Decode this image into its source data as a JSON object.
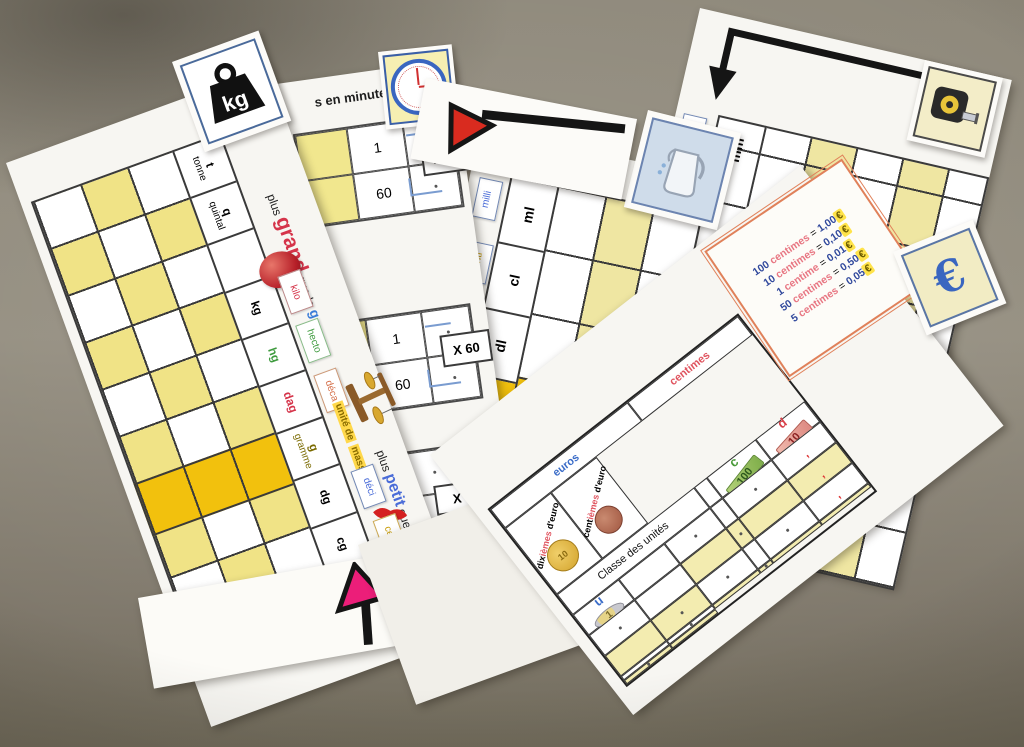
{
  "mass_paper": {
    "icon_label": "kg",
    "units": [
      {
        "abbr": "t",
        "name": "tonne"
      },
      {
        "abbr": "q",
        "name": "quintal"
      },
      {
        "abbr": "",
        "name": ""
      },
      {
        "abbr": "kg",
        "name": ""
      },
      {
        "abbr": "hg",
        "name": ""
      },
      {
        "abbr": "dag",
        "name": ""
      },
      {
        "abbr": "g",
        "name": "gramme"
      },
      {
        "abbr": "dg",
        "name": ""
      },
      {
        "abbr": "cg",
        "name": ""
      }
    ],
    "prefix_cards": [
      {
        "label": "kilo"
      },
      {
        "label": "hecto"
      },
      {
        "label": "déca"
      },
      {
        "label": "déci"
      },
      {
        "label": "centi"
      }
    ],
    "bigger_text": {
      "p1": "plus ",
      "p2": "grand",
      "p3": " que le ",
      "p4": "g"
    },
    "smaller_text": {
      "p1": "plus ",
      "p2": "petit",
      "p3": " que le ",
      "p4": "g"
    },
    "unit_chip": {
      "line1": "unité de",
      "line2": "masses"
    }
  },
  "time_paper": {
    "title": "s en minutes",
    "subtitle": "ondes",
    "table": {
      "top": "1",
      "bottom": "60"
    },
    "multiplier": "X 60",
    "multiplier_partial": "X"
  },
  "capacity_paper": {
    "units": [
      {
        "abbr": "ml"
      },
      {
        "abbr": "cl"
      },
      {
        "abbr": "dl"
      },
      {
        "abbr": "l"
      }
    ],
    "prefix_cards": [
      {
        "label": "milli"
      },
      {
        "label": "centi"
      },
      {
        "label": "déci"
      }
    ]
  },
  "length_paper": {
    "units": [
      {
        "abbr": "mm"
      }
    ],
    "prefix_cards": [
      {
        "label": "milli"
      },
      {
        "label": "centi"
      }
    ]
  },
  "money_paper": {
    "euros_label": "euros",
    "centimes_label": "centimes",
    "class_header": "Classe des unités",
    "columns": [
      {
        "letter": "c"
      },
      {
        "letter": "d"
      },
      {
        "letter": "u"
      }
    ],
    "tenths": {
      "p1": "dix",
      "p2": "ièmes",
      "p3": " d'euro"
    },
    "hundredths": {
      "p1": "cent",
      "p2": "ièmes",
      "p3": " d'euro"
    },
    "note_100": "100",
    "note_10": "10",
    "coin_10c": "10",
    "coin_1e": "1",
    "comma": ",",
    "euro_symbol": "€",
    "conversion": {
      "lines": [
        {
          "qty": "100",
          "unit": " centimes ",
          "eq": "= ",
          "value": "1,00",
          "cur": "€"
        },
        {
          "qty": "10",
          "unit": " centimes ",
          "eq": "= ",
          "value": "0,10",
          "cur": "€"
        },
        {
          "qty": "1",
          "unit": " centime ",
          "eq": "= ",
          "value": "0,01",
          "cur": "€"
        },
        {
          "qty": "50",
          "unit": " centimes ",
          "eq": "= ",
          "value": "0,50",
          "cur": "€"
        },
        {
          "qty": "5",
          "unit": " centimes ",
          "eq": "= ",
          "value": "0,05",
          "cur": "€"
        }
      ]
    }
  },
  "colors": {
    "stripe_yellow": "#f0e386",
    "highlight_gold": "#f2c10d",
    "paper_white": "#f7f6f2",
    "background_gray": "#8d8779",
    "accent_red": "#d92b1f",
    "accent_pink": "#ec1e79",
    "accent_blue": "#3a66c0",
    "conversion_border_orange": "#e0815a"
  }
}
